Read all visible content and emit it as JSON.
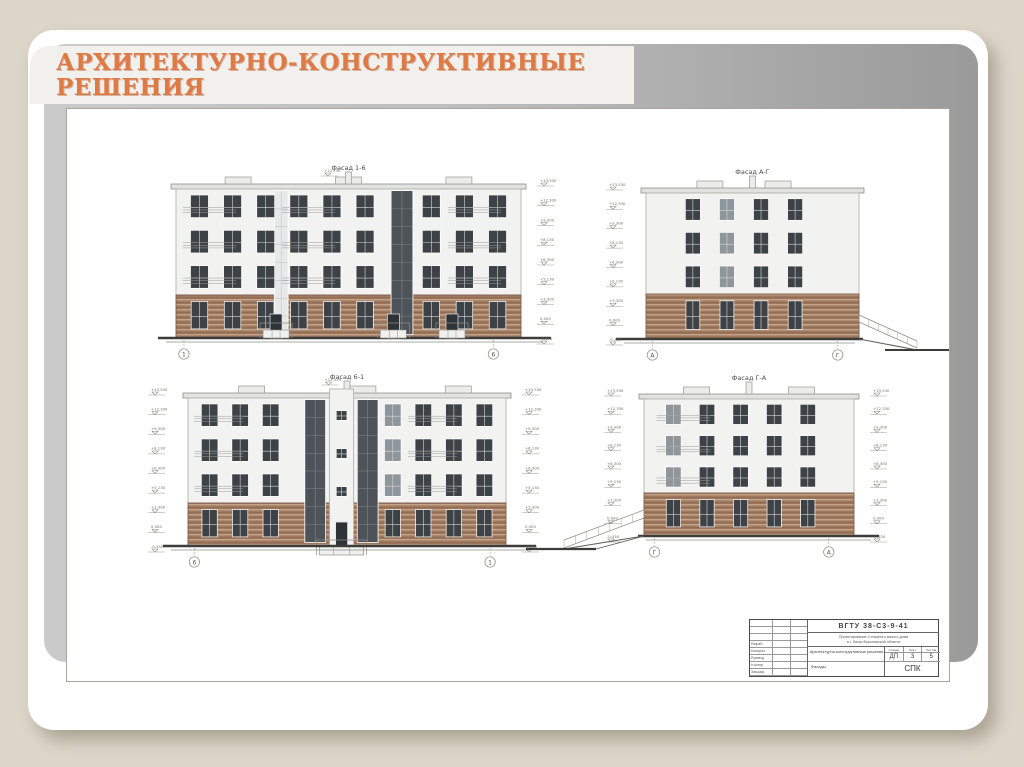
{
  "slide": {
    "title_line1": "АРХИТЕКТУРНО-КОНСТРУКТИВНЫЕ",
    "title_line2": "РЕШЕНИЯ",
    "accent_color": "#e07a45"
  },
  "drawing": {
    "elevation_values": [
      "+13,530",
      "+12,330",
      "+9,300",
      "+8,130",
      "+6,300",
      "+5,130",
      "+3,300",
      "0,000",
      "-0,450"
    ],
    "colors": {
      "body": "#f2f2f0",
      "brick_base": "#a07a5f",
      "brick_light": "#c4a488",
      "brick_dark": "#8a654e",
      "window": "#3d4246",
      "window_gray": "#8f969b",
      "glazing": "#4d5358",
      "glazing_light": "#e7e9e8",
      "line": "#8f8f8c",
      "ground": "#3c3c3a"
    },
    "facades": [
      {
        "id": "facade-1-6",
        "label": "Фасад 1-6",
        "x": 109,
        "y": 75,
        "w": 345,
        "h": 154,
        "brick": 0.28,
        "cols": 10,
        "col_region": [
          0.02,
          0.98
        ],
        "winw": 0.52,
        "skip_cols": [
          6
        ],
        "gray_cols": [],
        "strips": [
          {
            "fr": 0.305,
            "w": 13,
            "type": "light"
          },
          {
            "fr": 0.655,
            "w": 21,
            "type": "dark"
          }
        ],
        "rails": [
          0,
          3,
          8
        ],
        "entrances": [
          0.29,
          0.63,
          0.8
        ],
        "vents": [
          0.18,
          0.5,
          0.82
        ],
        "bubbles": [
          "1",
          "6"
        ],
        "bubble_fr": [
          0.023,
          0.92
        ],
        "marks": "right",
        "ramp": null,
        "roof_mark": true,
        "gext": [
          18,
          30
        ]
      },
      {
        "id": "facade-a-g",
        "label": "Фасад А-Г",
        "x": 579,
        "y": 79,
        "w": 213,
        "h": 151,
        "brick": 0.3,
        "cols": 4,
        "col_region": [
          0.14,
          0.78
        ],
        "winw": 0.42,
        "skip_cols": [],
        "gray_cols": [
          1
        ],
        "strips": [],
        "rails": [],
        "entrances": [],
        "vents": [
          0.3,
          0.62
        ],
        "bubbles": [
          "А",
          "Г"
        ],
        "bubble_fr": [
          0.03,
          0.9
        ],
        "marks": "left",
        "ramp": "right",
        "roof_mark": false,
        "gext": [
          30,
          4
        ]
      },
      {
        "id": "facade-6-1",
        "label": "Фасад 6-1",
        "x": 121,
        "y": 284,
        "w": 318,
        "h": 153,
        "brick": 0.28,
        "cols": 10,
        "col_region": [
          0.02,
          0.98
        ],
        "winw": 0.52,
        "skip_cols": [
          3,
          4,
          5
        ],
        "gray_cols": [
          6
        ],
        "strips": [
          {
            "fr": 0.4,
            "w": 20,
            "type": "dark"
          },
          {
            "fr": 0.565,
            "w": 20,
            "type": "dark"
          }
        ],
        "tower": 0.483,
        "rails": [
          0,
          7
        ],
        "entrances": [],
        "vents": [
          0.2,
          0.55,
          0.85
        ],
        "bubbles": [
          "6",
          "1"
        ],
        "bubble_fr": [
          0.02,
          0.95
        ],
        "marks": "both",
        "ramp": null,
        "roof_mark": true,
        "gext": [
          25,
          30
        ]
      },
      {
        "id": "facade-g-a",
        "label": "Фасад Г-А",
        "x": 577,
        "y": 285,
        "w": 210,
        "h": 142,
        "brick": 0.3,
        "cols": 5,
        "col_region": [
          0.06,
          0.86
        ],
        "winw": 0.44,
        "skip_cols": [],
        "gray_cols": [
          0
        ],
        "strips": [],
        "rails": [
          0
        ],
        "entrances": [],
        "vents": [
          0.25,
          0.75
        ],
        "bubbles": [
          "Г",
          "А"
        ],
        "bubble_fr": [
          0.05,
          0.88
        ],
        "marks": "both",
        "ramp": "left-long",
        "roof_mark": false,
        "gext": [
          6,
          25
        ]
      }
    ],
    "title_block": {
      "code": "ВГТУ 38-С3-9-41",
      "project_line1": "Проектирование 4-этажного жилого дома",
      "project_line2": "в г. Лиски Воронежской области",
      "doc_title": "Архитектурно-конструктивные решения",
      "doc_subtitle": "Фасады",
      "stage_label": "Стадия",
      "sheet_label": "Лист",
      "sheets_label": "Листов",
      "stage": "ДП",
      "sheet": "3",
      "sheets": "5",
      "org": "СПК",
      "roles": [
        "Разраб.",
        "Консульт.",
        "Руковод.",
        "Н.контр.",
        "Зав.каф."
      ]
    }
  }
}
